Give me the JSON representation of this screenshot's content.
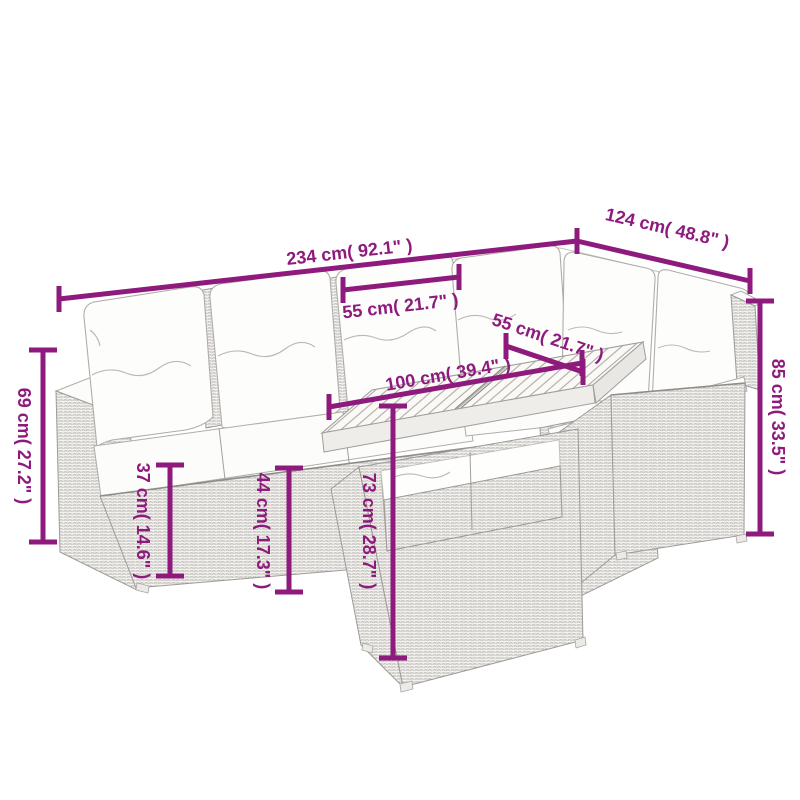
{
  "page": {
    "type": "product-dimension-diagram",
    "background": "#ffffff"
  },
  "product": {
    "name": "6-piece poly rattan garden lounge set with cushions and slatted wood-top table",
    "drawing_style": "gray line art with magenta dimension arrows"
  },
  "colors": {
    "dimension": "#8e1a7d",
    "line_art": "#a29f9b",
    "cushion_fill": "#fdfdfb"
  },
  "dimensions": {
    "total_width": {
      "label": "234 cm( 92.1\" )",
      "cm": 234,
      "inches": 92.1
    },
    "total_depth": {
      "label": "124 cm( 48.8\" )",
      "cm": 124,
      "inches": 48.8
    },
    "back_height": {
      "label": "85 cm( 33.5\" )",
      "cm": 85,
      "inches": 33.5
    },
    "arm_height": {
      "label": "69 cm( 27.2\" )",
      "cm": 69,
      "inches": 27.2
    },
    "seat_width": {
      "label": "55 cm( 21.7\" )",
      "cm": 55,
      "inches": 21.7
    },
    "table_depth": {
      "label": "55 cm( 21.7\" )",
      "cm": 55,
      "inches": 21.7
    },
    "table_length": {
      "label": "100 cm( 39.4\" )",
      "cm": 100,
      "inches": 39.4
    },
    "seat_height": {
      "label": "37 cm( 14.6\" )",
      "cm": 37,
      "inches": 14.6
    },
    "seat_cushion_height": {
      "label": "44 cm( 17.3\" )",
      "cm": 44,
      "inches": 17.3
    },
    "table_height": {
      "label": "73 cm( 28.7\" )",
      "cm": 73,
      "inches": 28.7
    }
  }
}
